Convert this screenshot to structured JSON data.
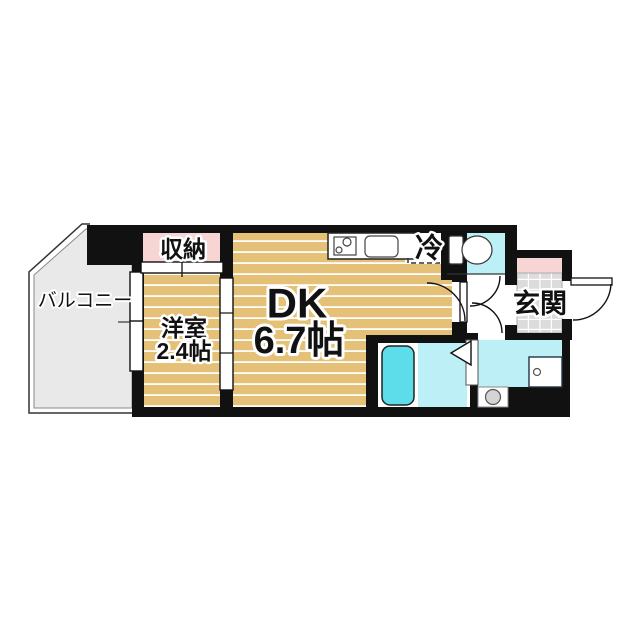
{
  "floorplan": {
    "balcony_label": "バルコニー",
    "closet_label": "収納",
    "western_room_label": "洋室",
    "western_room_size": "2.4帖",
    "dk_label": "DK",
    "dk_size": "6.7帖",
    "fridge_label": "冷",
    "entrance_label": "玄関",
    "fixtures": {
      "kitchen_counter": "stove-and-sink",
      "refrigerator_space": "dashed-outline",
      "toilet": "toilet-icon",
      "bathtub": "bathtub-icon",
      "vanity": "wash-basin-icon",
      "washing_machine": "washing-machine-icon",
      "bath_door": "folding-door-icon"
    },
    "colors": {
      "wall": "#111111",
      "floor_tan": "#e4c176",
      "floor_stripe": "#fdfdfd",
      "closet_pink": "#f8d5d5",
      "entrance_cabinet_pink": "#f8d5d5",
      "water_cyan": "#bdf0f6",
      "bathtub_cyan": "#5cdde9",
      "balcony_gray": "#e9e9e9",
      "entrance_tile_gray": "#dcdcdc",
      "washer_gray": "#d4d4d4"
    }
  }
}
